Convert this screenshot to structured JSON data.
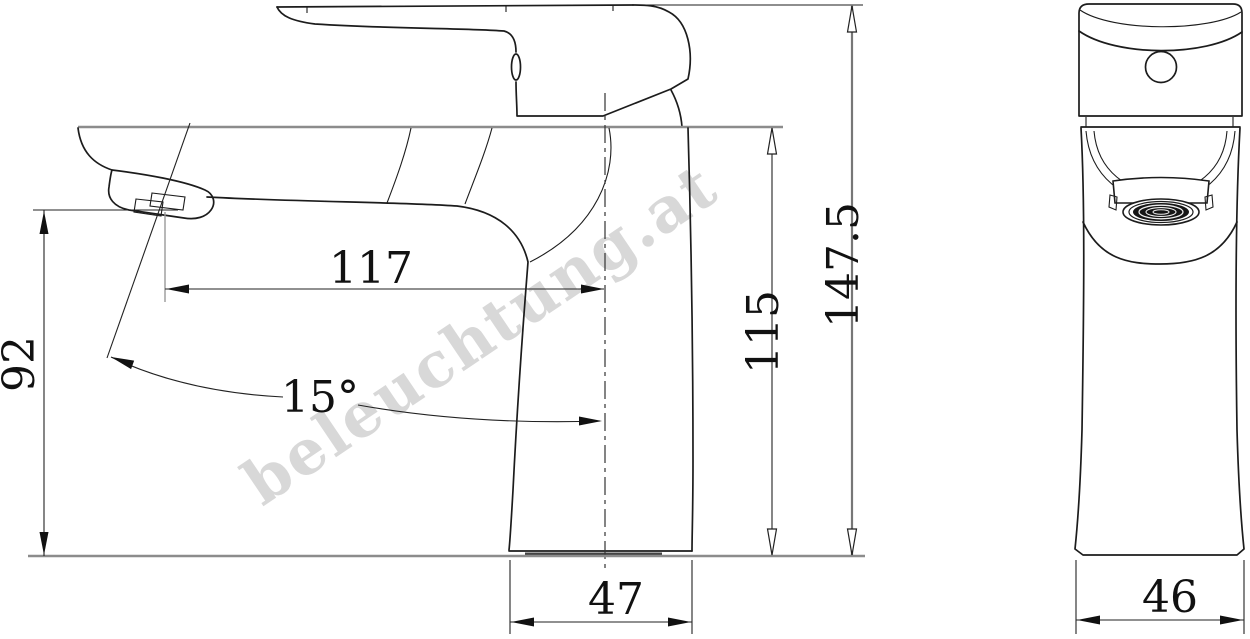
{
  "document": {
    "type": "technical-dimension-drawing",
    "subject": "single-lever basin mixer faucet",
    "background": "#ffffff",
    "line_color": "#1c1c1c",
    "reference_line_color": "#8c8c8c"
  },
  "watermark": {
    "text": "beleuchtung.at",
    "color": "#cfcfcf",
    "angle_deg": -34
  },
  "views": {
    "side": {
      "name": "side view"
    },
    "front": {
      "name": "front view"
    }
  },
  "dimensions": {
    "spout_height": {
      "label": "92",
      "meaning": "height from spout outlet to base",
      "orientation": "vertical-left"
    },
    "spout_reach": {
      "label": "117",
      "meaning": "horizontal reach from spout tip to body centerline",
      "orientation": "horizontal"
    },
    "spout_angle": {
      "label": "15°",
      "meaning": "spout inclination from vertical axis",
      "orientation": "angle"
    },
    "body_height": {
      "label": "115",
      "meaning": "height of body top edge above base",
      "orientation": "vertical-right"
    },
    "total_height": {
      "label": "147.5",
      "meaning": "overall height including lever",
      "orientation": "vertical-right"
    },
    "base_depth": {
      "label": "47",
      "meaning": "base footprint depth (side view)",
      "orientation": "horizontal-bottom"
    },
    "base_width": {
      "label": "46",
      "meaning": "base footprint width (front view)",
      "orientation": "horizontal-bottom"
    }
  }
}
